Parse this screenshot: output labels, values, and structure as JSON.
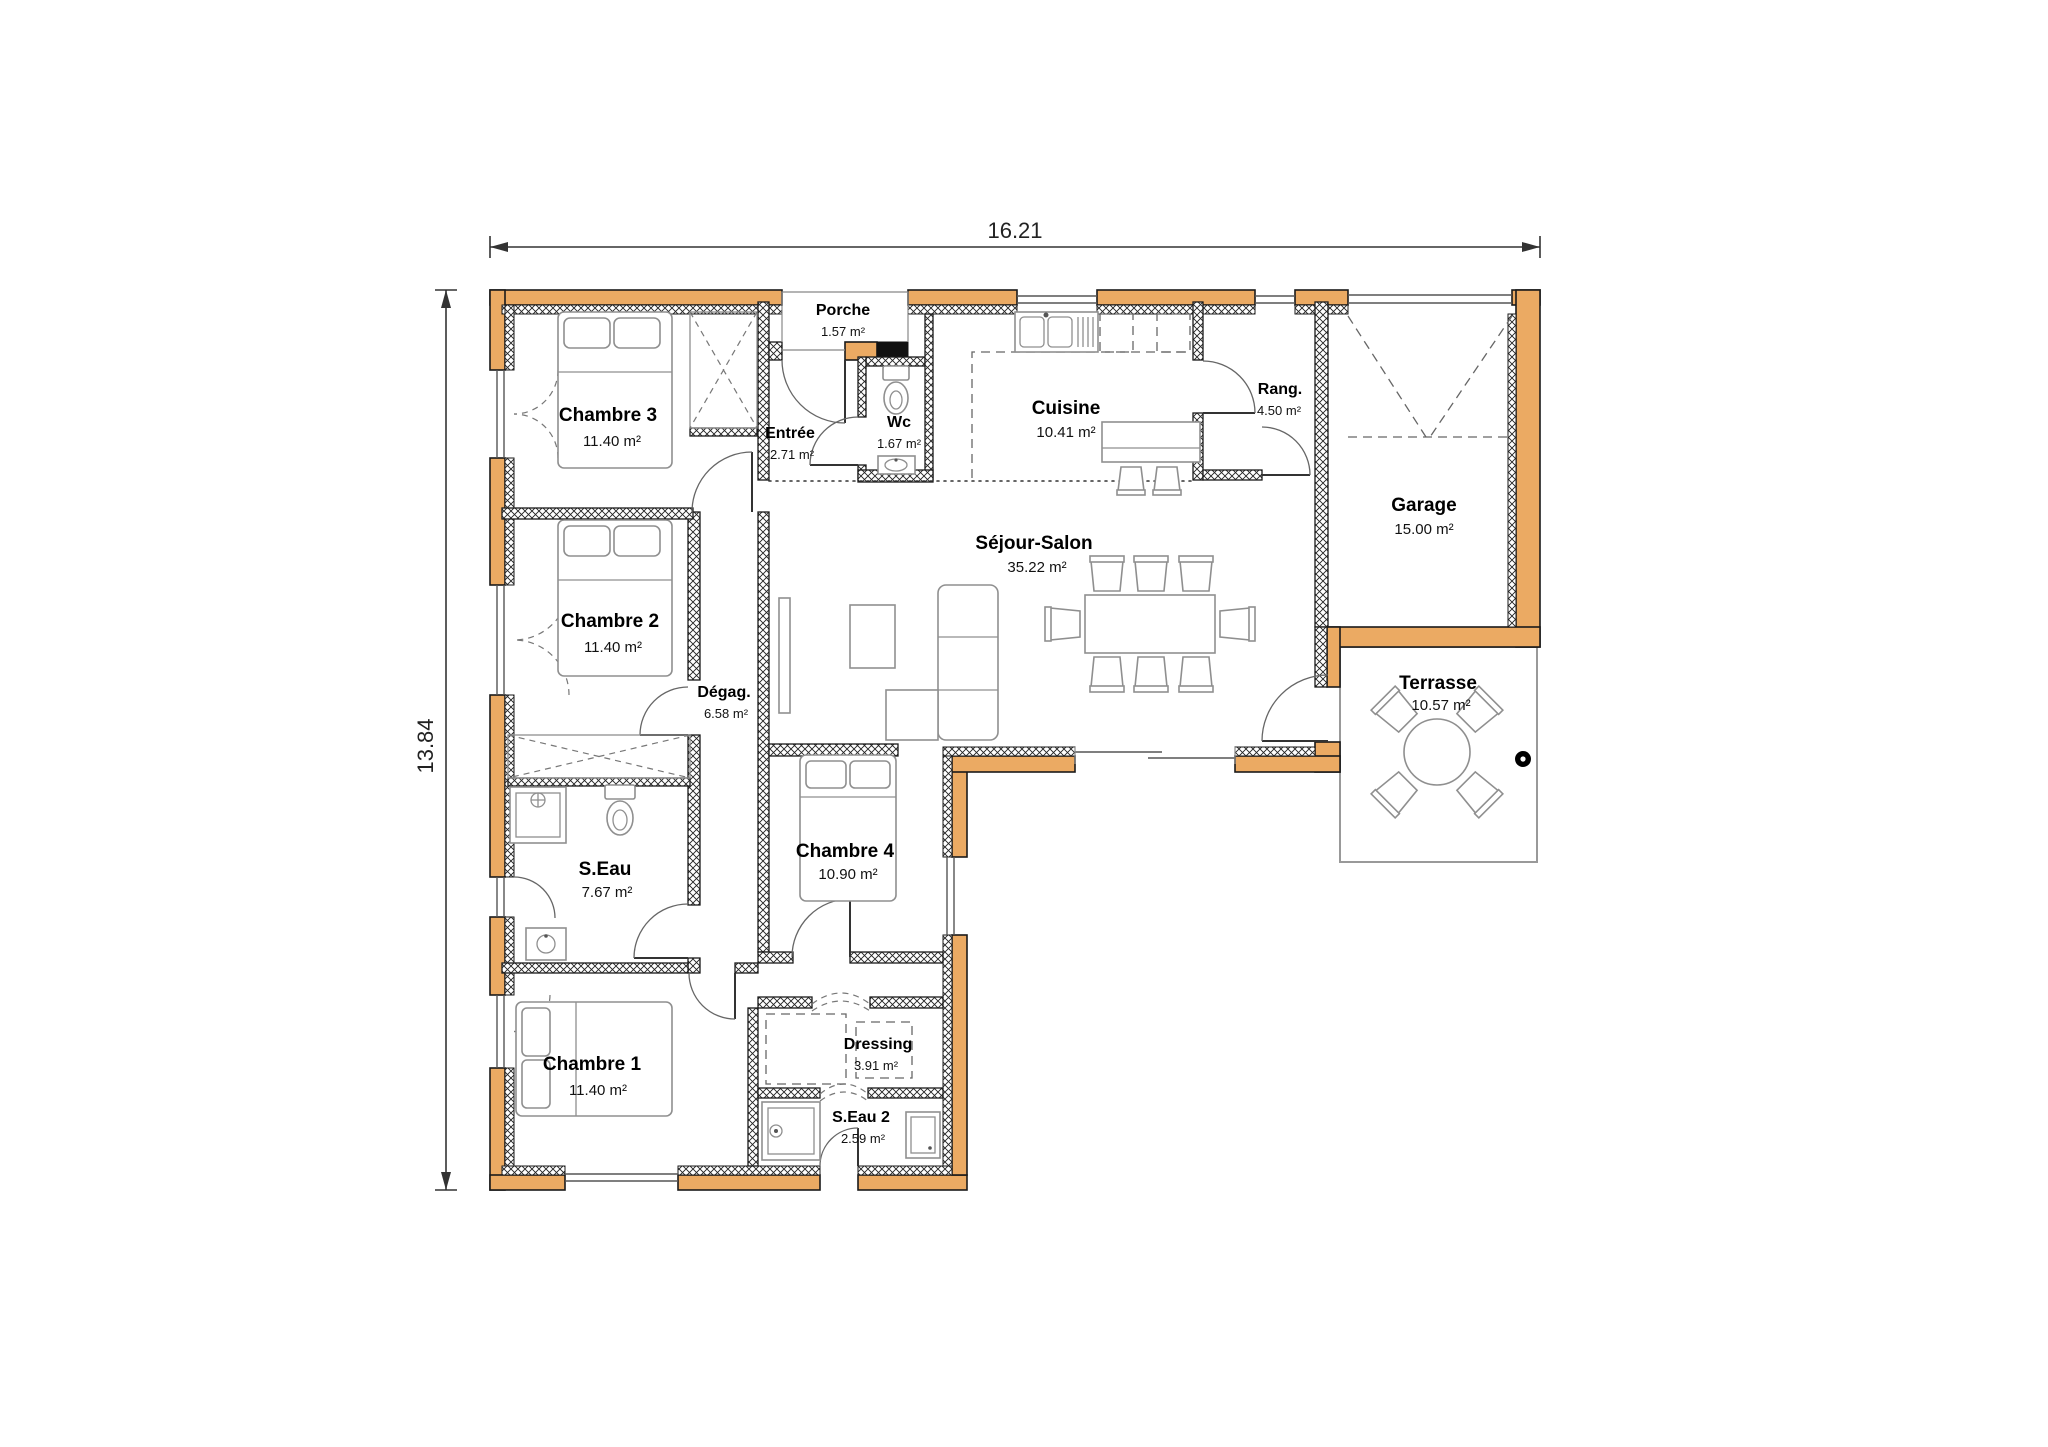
{
  "plan": {
    "title": "house-floor-plan",
    "dimensions": {
      "width_label": "16.21",
      "height_label": "13.84"
    },
    "colors": {
      "exterior_wall": "#EBAA63",
      "interior_wall_hatch": "#000000",
      "background": "#FFFFFF",
      "terrace_outline": "#999999"
    },
    "rooms": [
      {
        "name": "Porche",
        "area": "1.57 m²"
      },
      {
        "name": "Entrée",
        "area": "2.71 m²"
      },
      {
        "name": "Wc",
        "area": "1.67 m²"
      },
      {
        "name": "Cuisine",
        "area": "10.41 m²"
      },
      {
        "name": "Rang.",
        "area": "4.50 m²"
      },
      {
        "name": "Garage",
        "area": "15.00 m²"
      },
      {
        "name": "Chambre 3",
        "area": "11.40 m²"
      },
      {
        "name": "Chambre 2",
        "area": "11.40 m²"
      },
      {
        "name": "Dégag.",
        "area": "6.58 m²"
      },
      {
        "name": "Séjour-Salon",
        "area": "35.22 m²"
      },
      {
        "name": "S.Eau",
        "area": "7.67 m²"
      },
      {
        "name": "Chambre 4",
        "area": "10.90 m²"
      },
      {
        "name": "Chambre 1",
        "area": "11.40 m²"
      },
      {
        "name": "Dressing",
        "area": "3.91 m²"
      },
      {
        "name": "S.Eau 2",
        "area": "2.59 m²"
      },
      {
        "name": "Terrasse",
        "area": "10.57 m²"
      }
    ]
  }
}
